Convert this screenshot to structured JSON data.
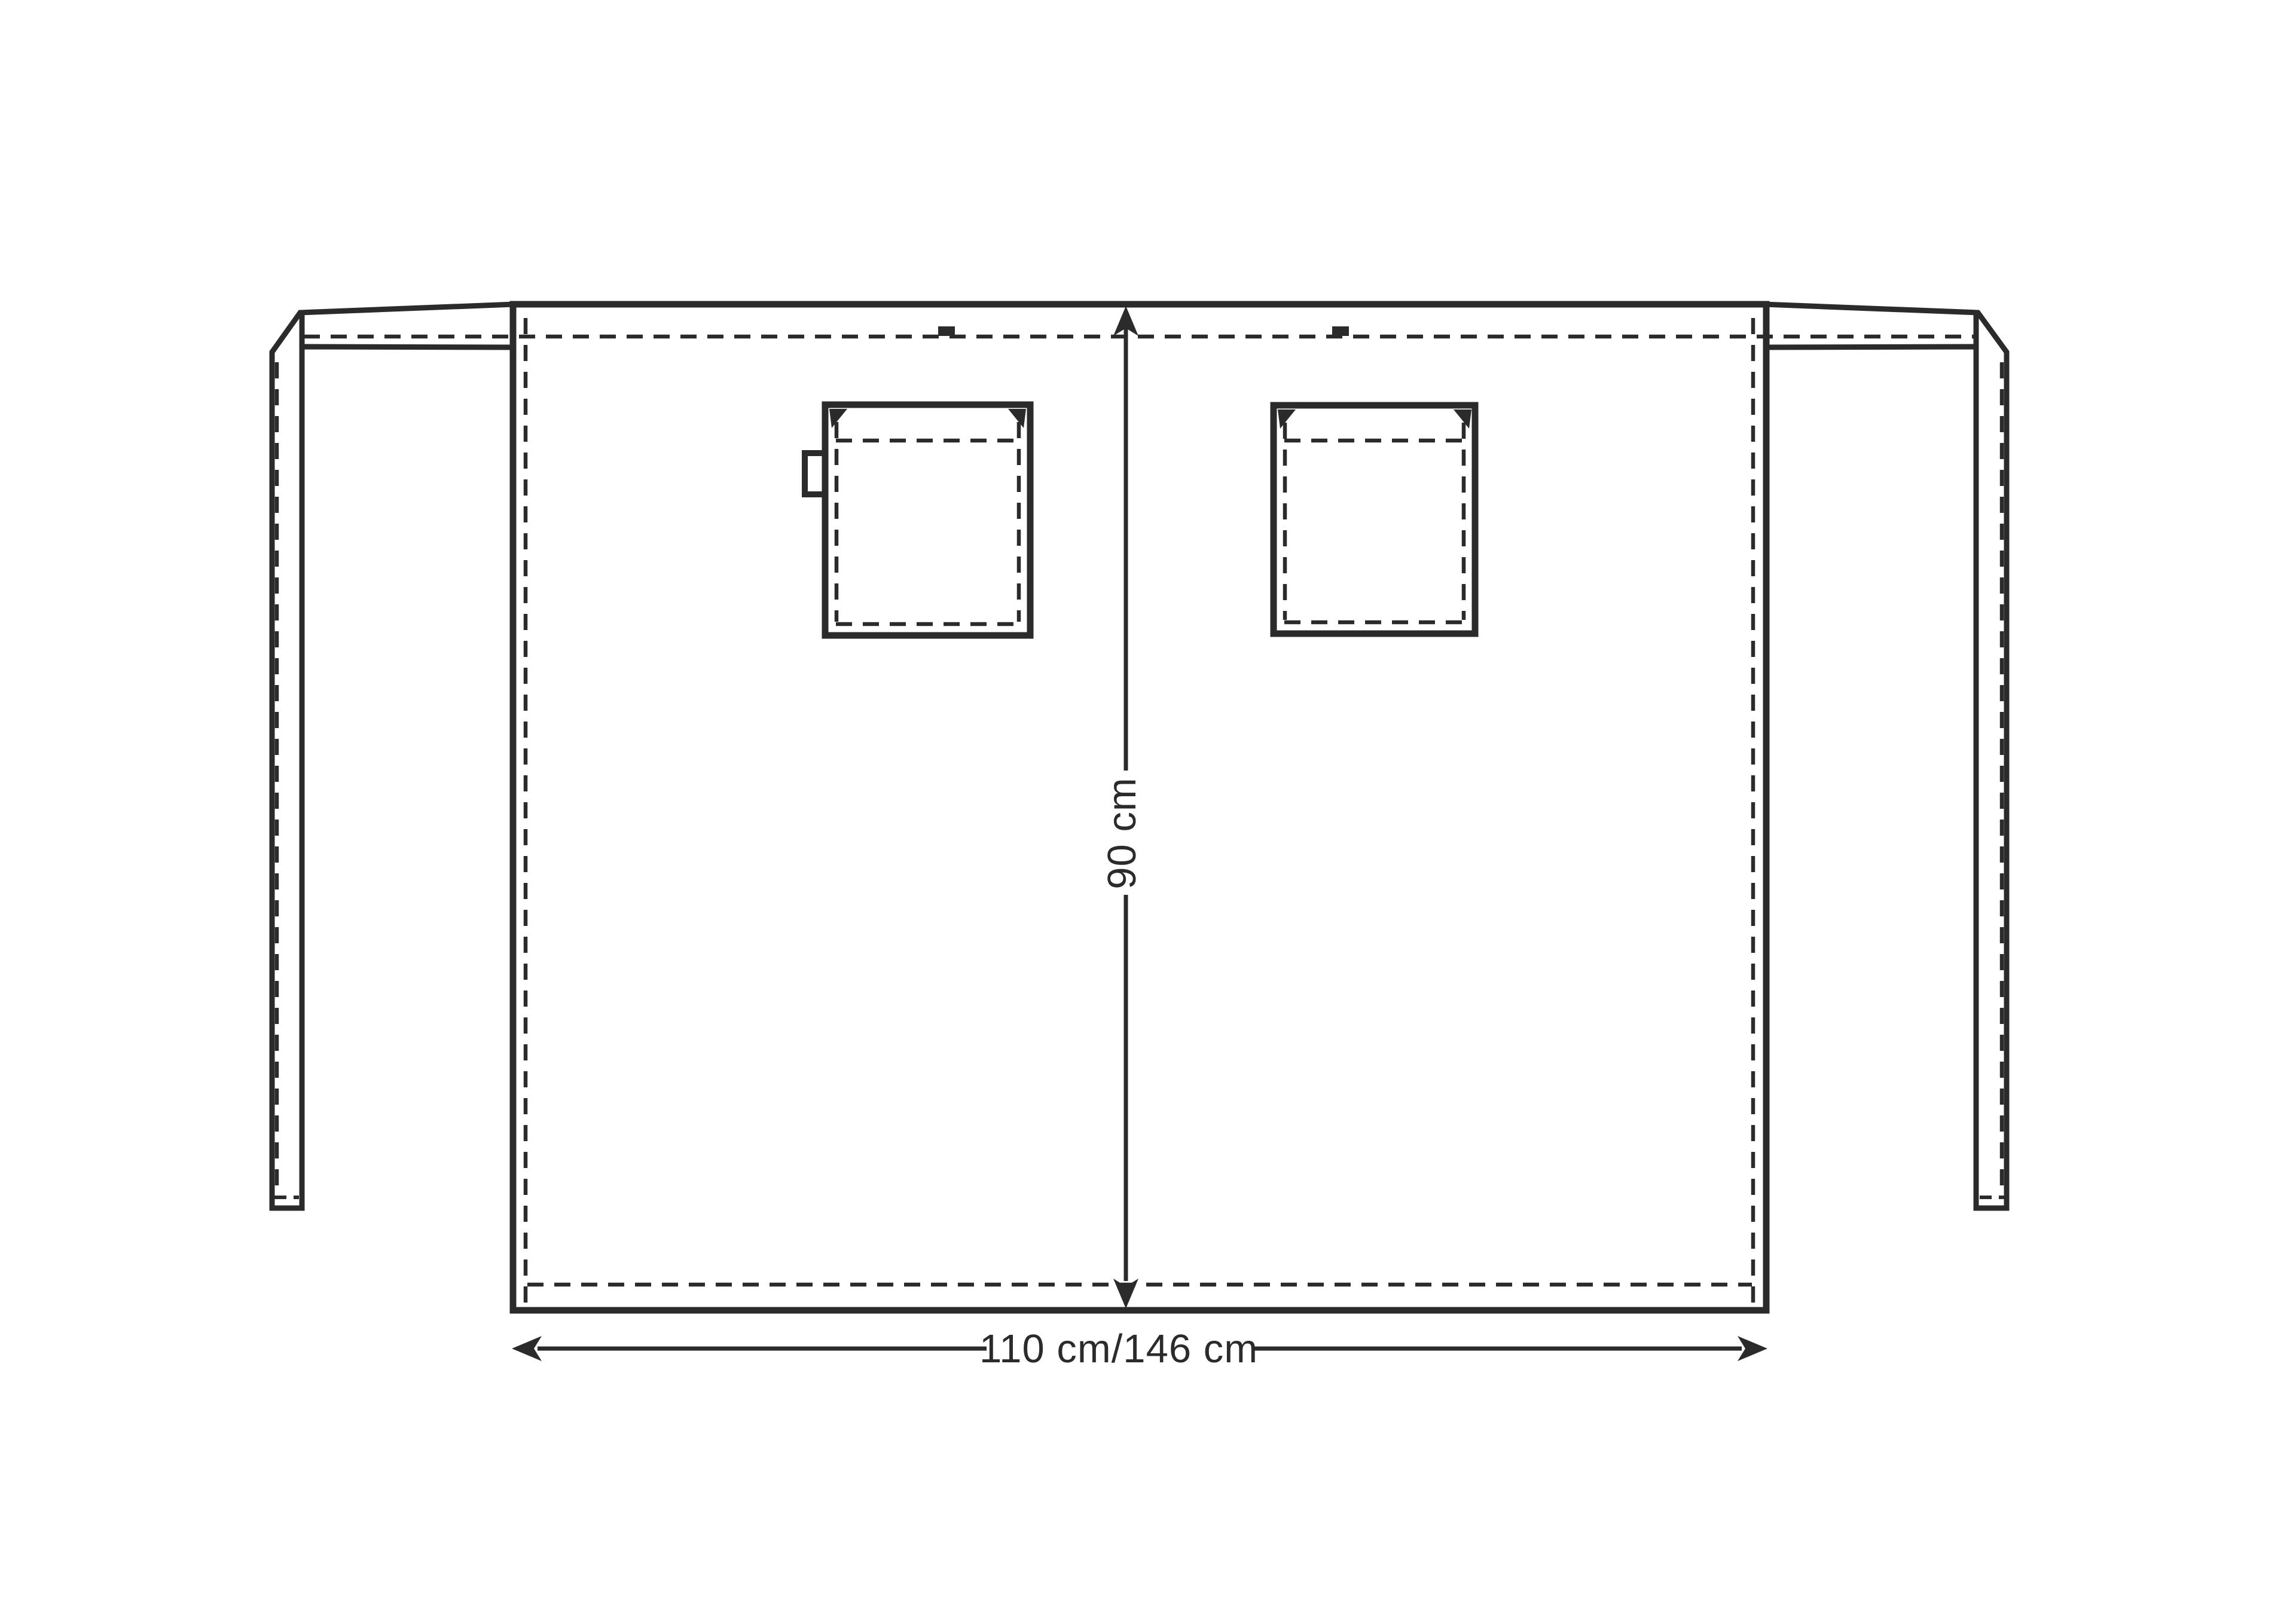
{
  "diagram": {
    "colors": {
      "line": "#2b2b2b",
      "background": "#ffffff"
    },
    "dimension_labels": {
      "height": "90 cm",
      "width": "110 cm/146 cm"
    }
  }
}
